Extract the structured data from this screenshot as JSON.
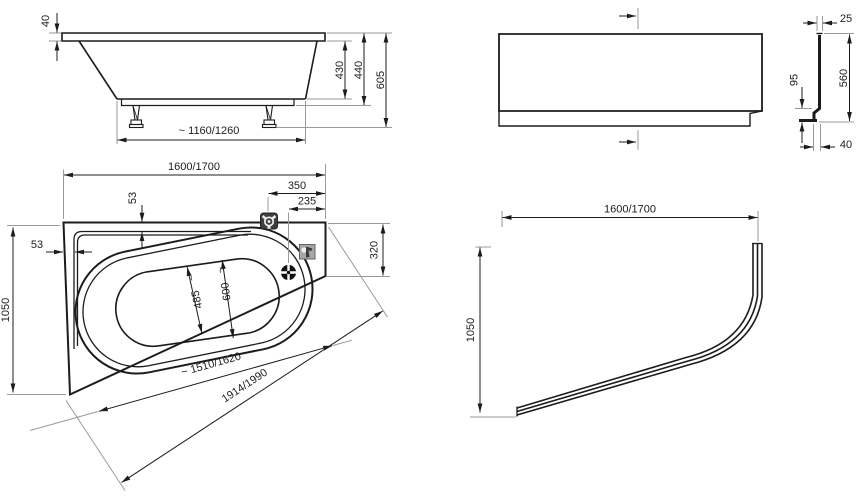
{
  "meta": {
    "type": "technical-drawing",
    "subject": "asymmetric corner bathtub with front panel and apron - dimensioned views",
    "background": "#ffffff",
    "line_color": "#1c1c1c",
    "extension_line_color": "#9a9a9a"
  },
  "side": {
    "rim_thickness": "40",
    "depth": "430",
    "shell_height": "440",
    "total_height": "605",
    "feet_spacing": "~ 1160/1260"
  },
  "panel": {
    "flange": "25",
    "step": "95",
    "height": "560",
    "foot": "40"
  },
  "plan": {
    "length": "1600/1700",
    "faucet_offset": "350",
    "waste_offset": "235",
    "rim_top": "53",
    "rim_left": "53",
    "width": "1050",
    "corner_edge": "320",
    "well_bottom": "485",
    "well_top": "600",
    "well_length": "~ 1510/1620",
    "diagonal": "1914/1990",
    "tilde": "~",
    "icons": {
      "tap": "mixer-tap-icon",
      "overflow": "overflow-icon",
      "drain": "drain-icon"
    }
  },
  "apron": {
    "length": "1600/1700",
    "width": "1050"
  }
}
